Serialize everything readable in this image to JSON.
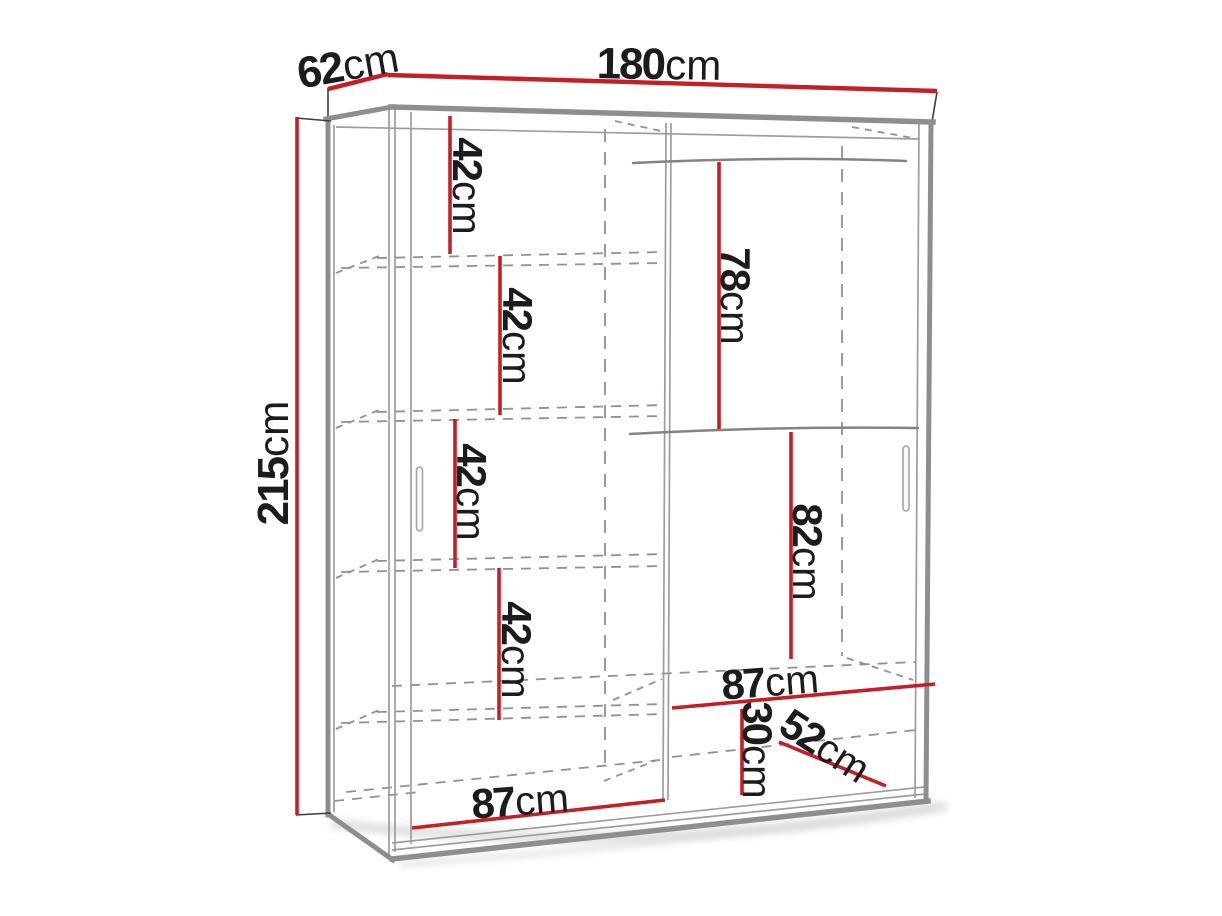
{
  "meta": {
    "description": "Technical line drawing of a two-door sliding wardrobe with interior dimension lines"
  },
  "colors": {
    "dimension_line": "#c41f27",
    "label_text": "#1c1c1c",
    "outline_bold": "#8d8f8e",
    "outline_thin": "#9c9e9d",
    "hidden_line": "#8f9192",
    "edge_black": "#3d3d3d",
    "shadow_tint": "#d8d9da"
  },
  "dimensions": {
    "total_width": {
      "value": "180",
      "unit": "cm"
    },
    "total_depth": {
      "value": "62",
      "unit": "cm"
    },
    "total_height": {
      "value": "215",
      "unit": "cm"
    },
    "left_shelf_gap_1": {
      "value": "42",
      "unit": "cm"
    },
    "left_shelf_gap_2": {
      "value": "42",
      "unit": "cm"
    },
    "left_shelf_gap_3": {
      "value": "42",
      "unit": "cm"
    },
    "left_shelf_gap_4": {
      "value": "42",
      "unit": "cm"
    },
    "right_top_section_height": {
      "value": "78",
      "unit": "cm"
    },
    "right_mid_section_height": {
      "value": "82",
      "unit": "cm"
    },
    "right_section_width": {
      "value": "87",
      "unit": "cm"
    },
    "right_bottom_gap": {
      "value": "30",
      "unit": "cm"
    },
    "interior_depth": {
      "value": "52",
      "unit": "cm"
    },
    "left_section_width": {
      "value": "87",
      "unit": "cm"
    }
  }
}
